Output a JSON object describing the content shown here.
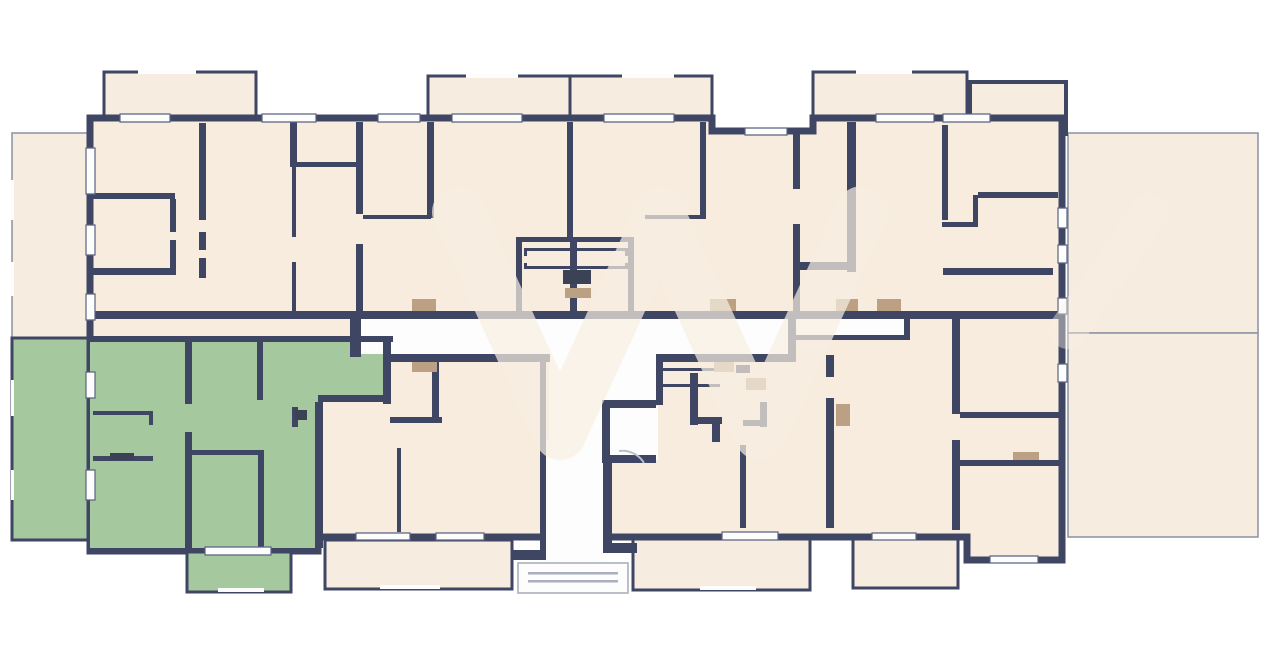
{
  "floorplan": {
    "canvas": {
      "width": 1270,
      "height": 671
    },
    "colors": {
      "background": "#ffffff",
      "wall": "#3e4664",
      "room": "#f8ecdf",
      "terrace": "#f6ecdf",
      "outline": "#9097a8",
      "highlight": "#a6c89f",
      "white": "#fdfdfe",
      "threshold": "#bba083",
      "fixture": "#3c4255",
      "watermark": "#f7efe2",
      "step": "#aab0bd",
      "window_line": "#5a6380",
      "door_arc": "#b9c0cc"
    },
    "highlighted_unit": {
      "fill": "#a6c89f",
      "position": "bottom-left",
      "includes": [
        "side-terrace",
        "rooms",
        "bottom-balcony"
      ]
    },
    "watermark": {
      "shape": "double-V logo",
      "opacity": 0.72
    },
    "elements": [
      "outer-terraces",
      "top-balconies",
      "bottom-balconies",
      "apartments",
      "central-corridor",
      "stairs",
      "elevator",
      "entrance-porch",
      "windows",
      "door-thresholds",
      "radiators"
    ]
  }
}
